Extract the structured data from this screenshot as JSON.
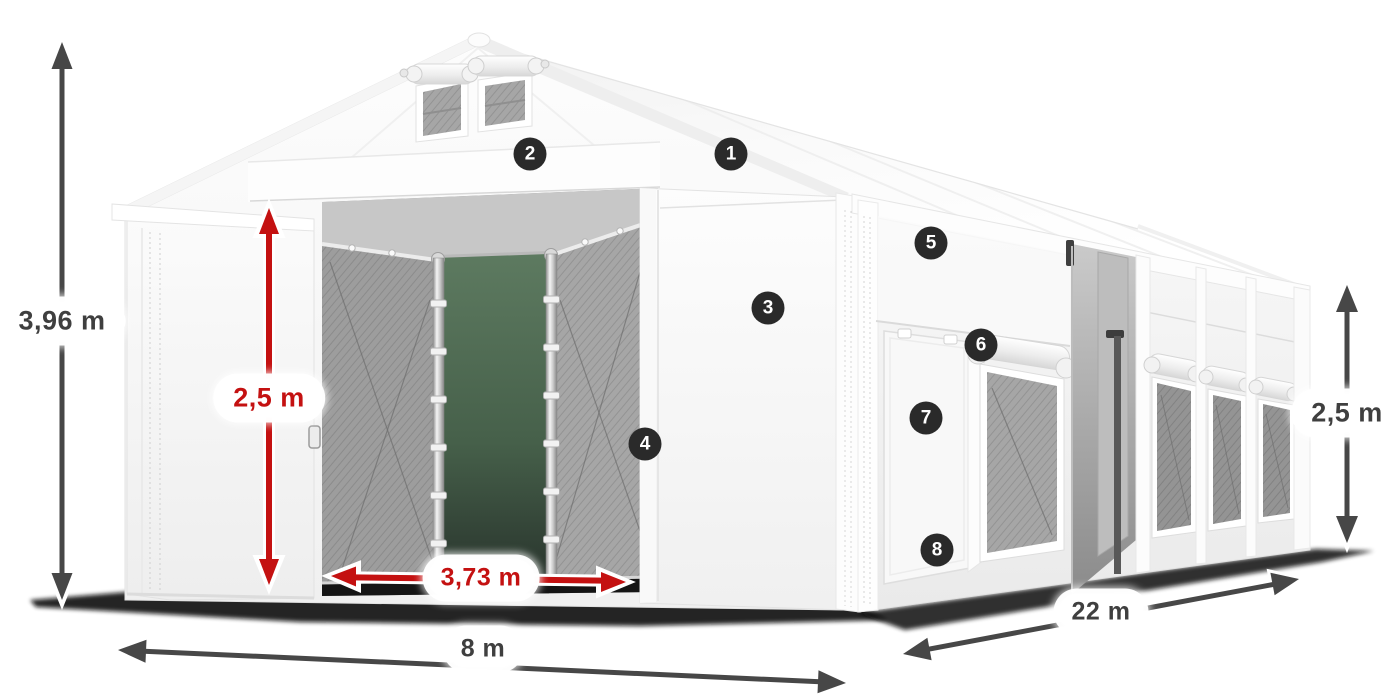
{
  "page": {
    "background_color": "#ffffff"
  },
  "diagram": {
    "subject": "White PVC storage tent with open entrance, mesh windows and dimension annotations",
    "annotations": {
      "total_height": "3,96 m",
      "entrance_height": "2,5 m",
      "entrance_width": "3,73 m",
      "tent_width": "8 m",
      "tent_length": "22 m",
      "side_wall_height": "2,5 m"
    },
    "callouts": [
      "1",
      "2",
      "3",
      "4",
      "5",
      "6",
      "7",
      "8"
    ],
    "colors": {
      "dimension_arrow_gray": "#474747",
      "dimension_text_gray": "#3f3f3f",
      "dimension_red": "#c41111",
      "callout_background": "#2a2a2a",
      "callout_text": "#ffffff",
      "label_background": "#ffffff",
      "tent_white": "#f8f8f8",
      "mesh_gray": "#a2a2a2",
      "interior_green": "#4d6750",
      "shadow_black": "#111111"
    }
  }
}
